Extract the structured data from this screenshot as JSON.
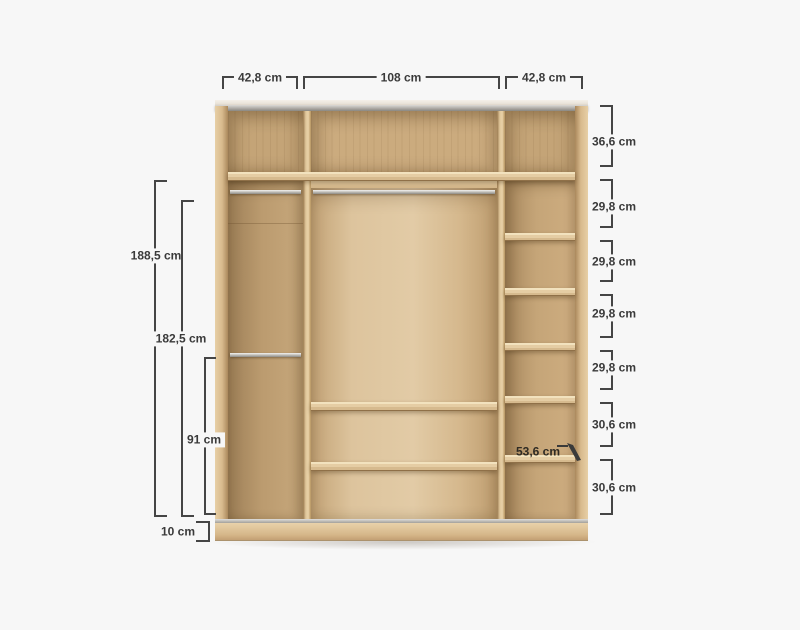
{
  "diagram": {
    "subject": "wardrobe-interior-dimension-diagram",
    "unit": "cm",
    "colors": {
      "background": "#f7f7f7",
      "dimension_lines": "#454545",
      "dimension_text": "#3a3a3a",
      "wood_light": "#e2cba6",
      "wood_medium": "#c7a87c",
      "wood_dark": "#9d7f57",
      "metal_rail": "#b7b4ae"
    },
    "top_dimensions": [
      {
        "label": "42,8 cm"
      },
      {
        "label": "108 cm"
      },
      {
        "label": "42,8 cm"
      }
    ],
    "left_dimensions": [
      {
        "label": "188,5 cm"
      },
      {
        "label": "182,5 cm"
      },
      {
        "label": "91 cm"
      },
      {
        "label": "10 cm"
      }
    ],
    "right_dimensions": [
      {
        "label": "36,6 cm"
      },
      {
        "label": "29,8 cm"
      },
      {
        "label": "29,8 cm"
      },
      {
        "label": "29,8 cm"
      },
      {
        "label": "29,8 cm"
      },
      {
        "label": "30,6 cm"
      },
      {
        "label": "30,6 cm"
      }
    ],
    "depth_dimension": {
      "label": "53,6 cm"
    }
  }
}
